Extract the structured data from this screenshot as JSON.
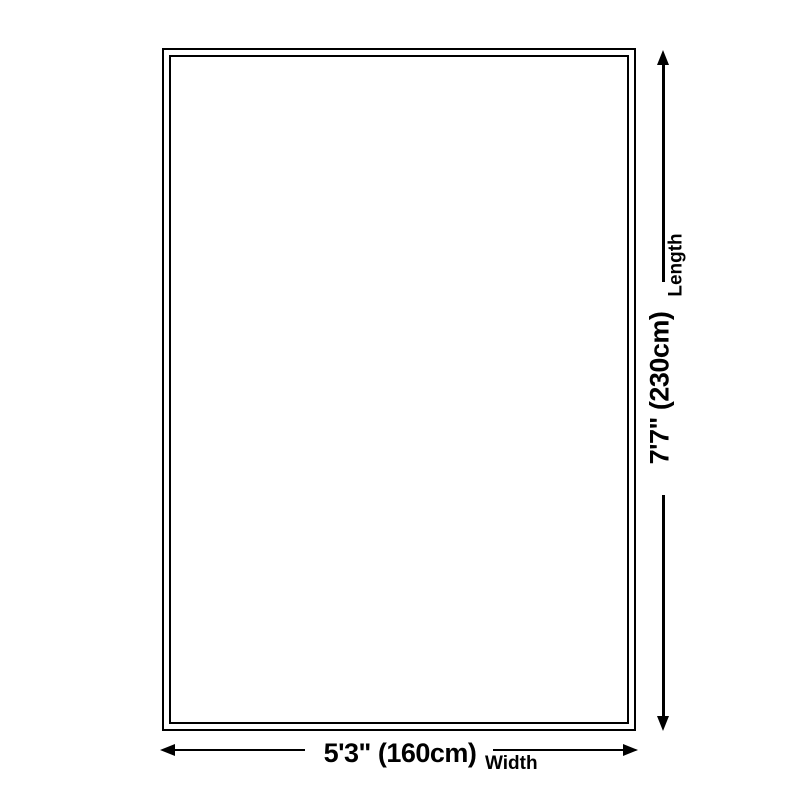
{
  "diagram": {
    "type": "product-dimension-diagram",
    "width": {
      "value": "5'3\" (160cm)",
      "label": "Width"
    },
    "length": {
      "value": "7'7\" (230cm)",
      "label": "Length"
    },
    "colors": {
      "line": "#000000",
      "background": "#ffffff"
    }
  }
}
